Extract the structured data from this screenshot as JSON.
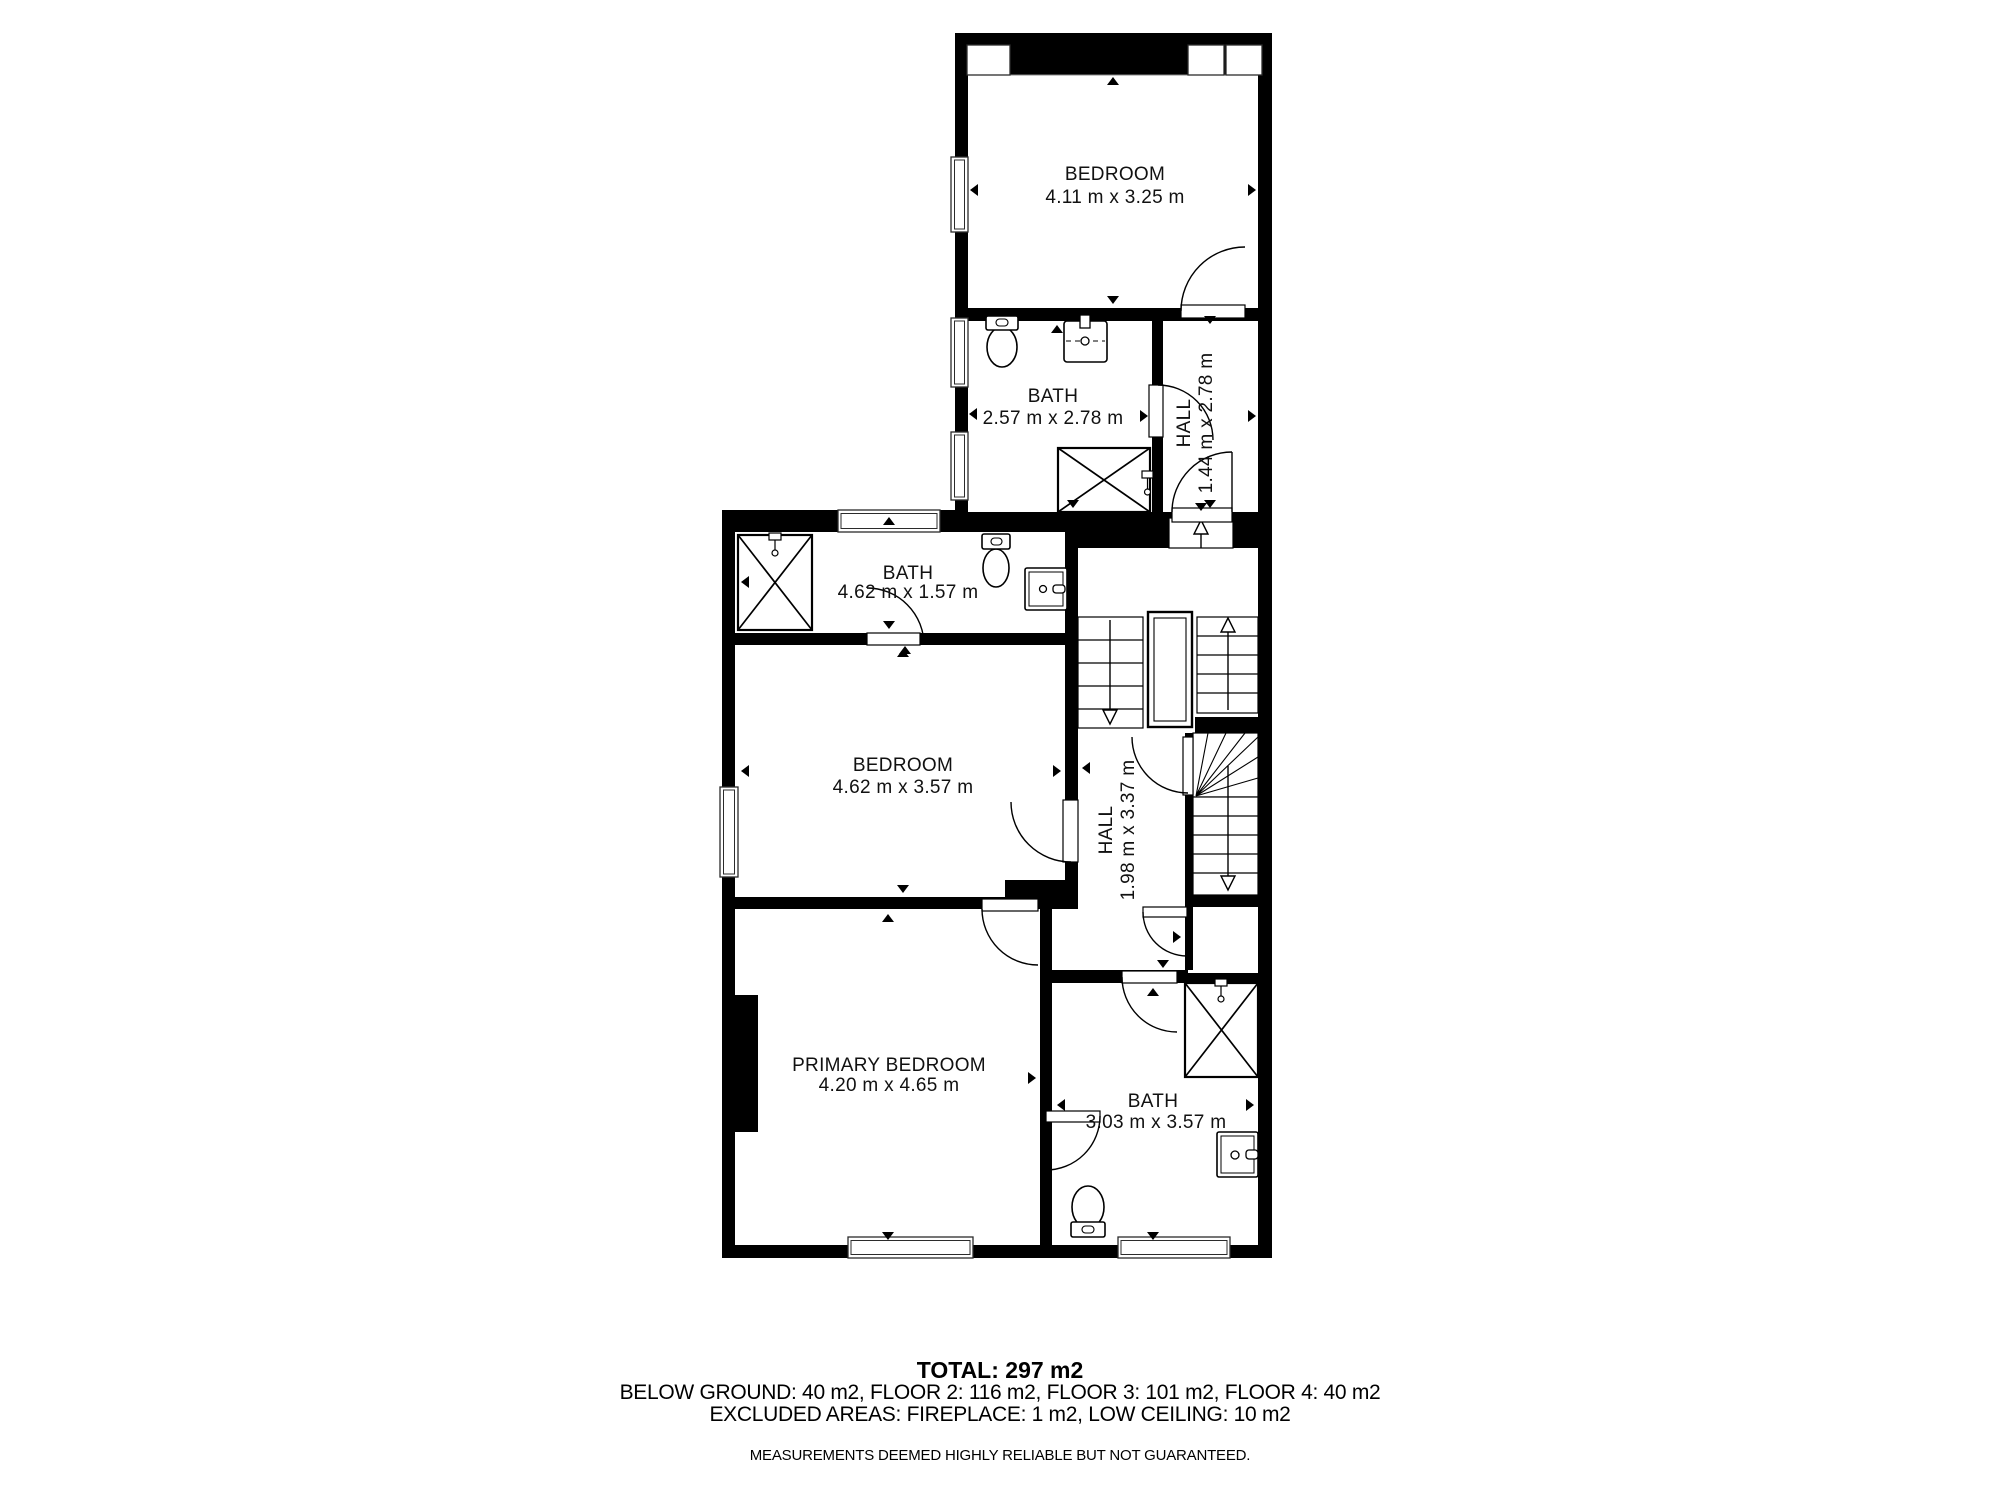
{
  "colors": {
    "wall": "#000000",
    "background": "#ffffff",
    "line": "#1a1a1a"
  },
  "rooms": [
    {
      "id": "bedroom-top",
      "label": "BEDROOM",
      "dimensions": "4.11 m x 3.25 m"
    },
    {
      "id": "bath-top",
      "label": "BATH",
      "dimensions": "2.57 m x 2.78 m"
    },
    {
      "id": "hall-top",
      "label": "HALL",
      "dimensions": "1.44 m x 2.78 m"
    },
    {
      "id": "bath-mid",
      "label": "BATH",
      "dimensions": "4.62 m x 1.57 m"
    },
    {
      "id": "bedroom-mid",
      "label": "BEDROOM",
      "dimensions": "4.62 m x 3.57 m"
    },
    {
      "id": "hall-mid",
      "label": "HALL",
      "dimensions": "1.98 m x 3.37 m"
    },
    {
      "id": "primary-bedroom",
      "label": "PRIMARY BEDROOM",
      "dimensions": "4.20 m x 4.65 m"
    },
    {
      "id": "bath-bottom",
      "label": "BATH",
      "dimensions": "3.03 m x 3.57 m"
    }
  ],
  "footer": {
    "total": "TOTAL: 297 m2",
    "floors": "BELOW GROUND: 40 m2, FLOOR 2: 116 m2, FLOOR 3: 101 m2, FLOOR 4: 40 m2",
    "excluded": "EXCLUDED AREAS: FIREPLACE: 1 m2, LOW CEILING: 10 m2",
    "disclaimer": "MEASUREMENTS DEEMED HIGHLY RELIABLE BUT NOT GUARANTEED."
  }
}
